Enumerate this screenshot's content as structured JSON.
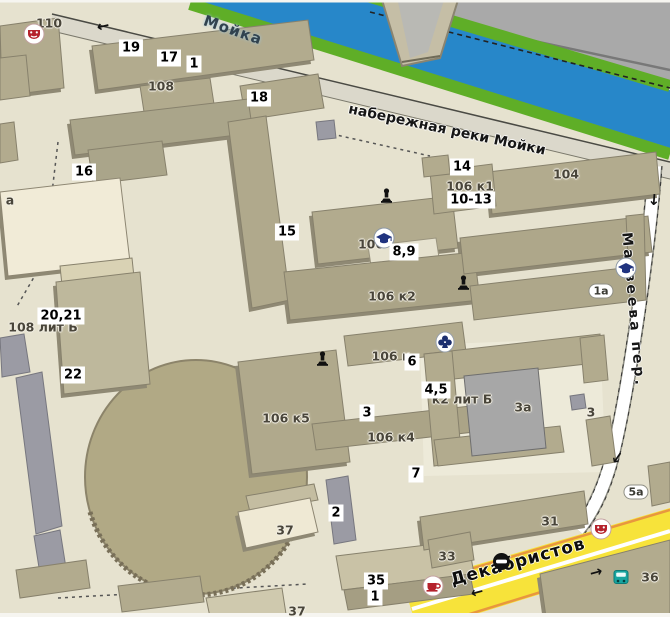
{
  "map": {
    "streets": {
      "river": "Мойка",
      "embankment": "набережная реки Мойки",
      "lane": "Матвеева пер.",
      "street": "Декабристов"
    },
    "markers": [
      {
        "label": "19",
        "x": 131,
        "y": 48
      },
      {
        "label": "17",
        "x": 169,
        "y": 58
      },
      {
        "label": "1",
        "x": 194,
        "y": 64
      },
      {
        "label": "18",
        "x": 259,
        "y": 98
      },
      {
        "label": "16",
        "x": 84,
        "y": 172
      },
      {
        "label": "14",
        "x": 462,
        "y": 167
      },
      {
        "label": "10-13",
        "x": 471,
        "y": 200
      },
      {
        "label": "15",
        "x": 287,
        "y": 232
      },
      {
        "label": "8,9",
        "x": 404,
        "y": 252
      },
      {
        "label": "20,21",
        "x": 61,
        "y": 316
      },
      {
        "label": "22",
        "x": 73,
        "y": 375
      },
      {
        "label": "6",
        "x": 412,
        "y": 362
      },
      {
        "label": "4,5",
        "x": 436,
        "y": 390
      },
      {
        "label": "3",
        "x": 367,
        "y": 413
      },
      {
        "label": "7",
        "x": 416,
        "y": 474
      },
      {
        "label": "2",
        "x": 336,
        "y": 513
      },
      {
        "label": "35",
        "x": 376,
        "y": 581
      },
      {
        "label": "1",
        "x": 375,
        "y": 597
      }
    ],
    "building_labels": [
      {
        "label": "110",
        "x": 49,
        "y": 23
      },
      {
        "label": "108",
        "x": 161,
        "y": 86
      },
      {
        "label": "а",
        "x": 10,
        "y": 200
      },
      {
        "label": "104",
        "x": 566,
        "y": 174
      },
      {
        "label": "106 к1",
        "x": 470,
        "y": 186
      },
      {
        "label": "106",
        "x": 371,
        "y": 244
      },
      {
        "label": "106 к2",
        "x": 392,
        "y": 296
      },
      {
        "label": "106 к",
        "x": 391,
        "y": 356
      },
      {
        "label": "к2 лит Б",
        "x": 462,
        "y": 399
      },
      {
        "label": "3а",
        "x": 523,
        "y": 407
      },
      {
        "label": "3",
        "x": 591,
        "y": 412
      },
      {
        "label": "106 к5",
        "x": 286,
        "y": 418
      },
      {
        "label": "106 к4",
        "x": 391,
        "y": 437
      },
      {
        "label": "108 лит Б",
        "x": 43,
        "y": 327
      },
      {
        "label": "37",
        "x": 285,
        "y": 530
      },
      {
        "label": "31",
        "x": 550,
        "y": 521
      },
      {
        "label": "33",
        "x": 447,
        "y": 556
      },
      {
        "label": "36",
        "x": 650,
        "y": 577
      },
      {
        "label": "37",
        "x": 297,
        "y": 611
      }
    ],
    "pill_labels": [
      {
        "label": "1а",
        "x": 601,
        "y": 291
      },
      {
        "label": "5а",
        "x": 636,
        "y": 492
      }
    ],
    "icons": [
      {
        "type": "theatre",
        "x": 23,
        "y": 23
      },
      {
        "type": "theatre",
        "x": 590,
        "y": 518
      },
      {
        "type": "cafe",
        "x": 422,
        "y": 575
      },
      {
        "type": "education",
        "x": 373,
        "y": 227
      },
      {
        "type": "education",
        "x": 615,
        "y": 257
      },
      {
        "type": "monument",
        "x": 380,
        "y": 188
      },
      {
        "type": "monument",
        "x": 457,
        "y": 275
      },
      {
        "type": "monument",
        "x": 316,
        "y": 351
      },
      {
        "type": "club",
        "x": 435,
        "y": 331
      },
      {
        "type": "barrier",
        "x": 492,
        "y": 552
      },
      {
        "type": "bus-stop",
        "x": 613,
        "y": 570
      }
    ],
    "arrows": [
      {
        "glyph": "←",
        "x": 103,
        "y": 26,
        "rot": -13
      },
      {
        "glyph": "↓",
        "x": 654,
        "y": 200,
        "rot": 4
      },
      {
        "glyph": "↓",
        "x": 617,
        "y": 458,
        "rot": 35
      },
      {
        "glyph": "→",
        "x": 596,
        "y": 572,
        "rot": -15
      },
      {
        "glyph": "←",
        "x": 477,
        "y": 592,
        "rot": -15
      }
    ],
    "colors": {
      "water": "#2787c9",
      "bank_green": "#5fae27",
      "land": "#e6e2cf",
      "building": "#b2ab8e",
      "cream_building": "#f1ebd7",
      "gray_area": "#a9a9a9",
      "road_yellow": "#f7e33a",
      "road_orange_edge": "#e8973e",
      "accent_red": "#b5222c",
      "accent_blue": "#20337f"
    }
  }
}
